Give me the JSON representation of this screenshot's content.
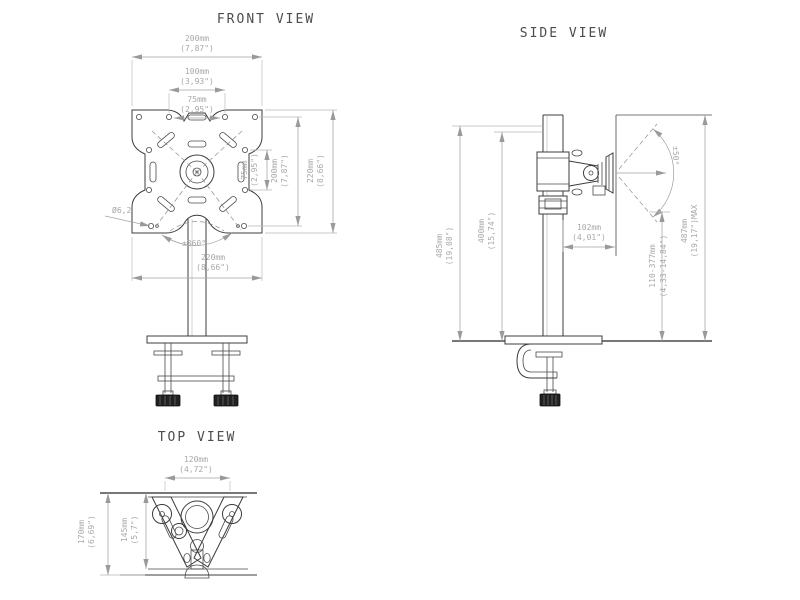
{
  "drawing": {
    "front": {
      "title": "FRONT VIEW",
      "dims": {
        "w200": {
          "mm": "200mm",
          "in": "(7,87\")"
        },
        "w100": {
          "mm": "100mm",
          "in": "(3,93\")"
        },
        "w75": {
          "mm": "75mm",
          "in": "(2,95\")"
        },
        "v75": {
          "mm": "75mm",
          "in": "(2,95\")"
        },
        "v200": {
          "mm": "200mm",
          "in": "(7,87\")"
        },
        "v220": {
          "mm": "220mm",
          "in": "(8,66\")"
        },
        "w220": {
          "mm": "220mm",
          "in": "(8,66\")"
        },
        "hole": "Ø6,2",
        "rotation": "±360°"
      }
    },
    "side": {
      "title": "SIDE VIEW",
      "dims": {
        "v485": {
          "mm": "485mm",
          "in": "(19,08\")"
        },
        "v400": {
          "mm": "400mm",
          "in": "(15,74\")"
        },
        "d102": {
          "mm": "102mm",
          "in": "(4,01\")"
        },
        "range": {
          "mm": "110-377mm",
          "in": "(4,33-14,84\")"
        },
        "max": {
          "mm": "487mm",
          "in": "(19,17\")MAX"
        },
        "tilt": "±50°"
      }
    },
    "top": {
      "title": "TOP VIEW",
      "dims": {
        "w120": {
          "mm": "120mm",
          "in": "(4,72\")"
        },
        "v170": {
          "mm": "170mm",
          "in": "(6,69\")"
        },
        "v145": {
          "mm": "145mm",
          "in": "(5,7\")"
        }
      }
    }
  }
}
